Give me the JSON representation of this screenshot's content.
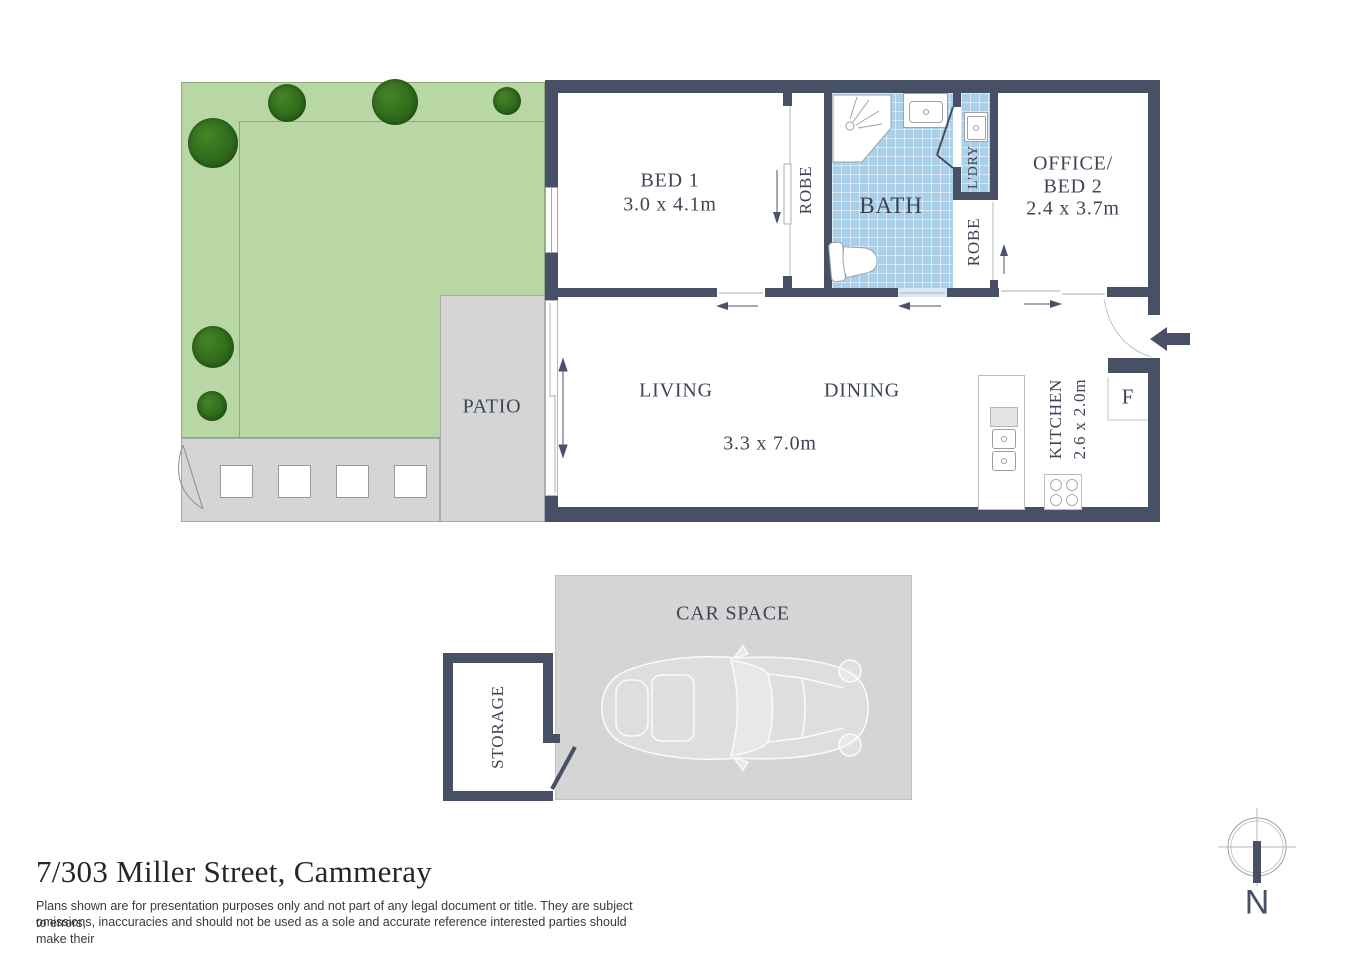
{
  "palette": {
    "wall": "#475064",
    "floor": "#ffffff",
    "tile_blue": "#aacfe9",
    "garden_green": "#b9d6a5",
    "tree_green": "#2f6b1b",
    "paving_gray": "#d5d5d6",
    "label_text": "#3d4555"
  },
  "title": {
    "address": "7/303 Miller Street, Cammeray",
    "disclaimer_line1": "Plans shown are for presentation purposes only and not part of any legal document or title. They are subject to errors,",
    "disclaimer_line2": "omissions, inaccuracies and should not be used as a sole and accurate reference interested parties should make their"
  },
  "compass": {
    "north_label": "N"
  },
  "rooms": {
    "bed1": {
      "name": "BED 1",
      "dims": "3.0 x 4.1m"
    },
    "robe1": {
      "name": "ROBE"
    },
    "bath": {
      "name": "BATH"
    },
    "laundry": {
      "name": "L'DRY"
    },
    "robe2": {
      "name": "ROBE"
    },
    "office": {
      "name_line1": "OFFICE/",
      "name_line2": "BED 2",
      "dims": "2.4 x 3.7m"
    },
    "living": {
      "name": "LIVING"
    },
    "dining": {
      "name": "DINING"
    },
    "living_dining": {
      "dims": "3.3 x 7.0m"
    },
    "kitchen": {
      "name": "KITCHEN",
      "dims": "2.6 x 2.0m"
    },
    "fridge": {
      "label": "F"
    },
    "patio": {
      "name": "PATIO"
    },
    "car_space": {
      "name": "CAR SPACE"
    },
    "storage": {
      "name": "STORAGE"
    }
  }
}
